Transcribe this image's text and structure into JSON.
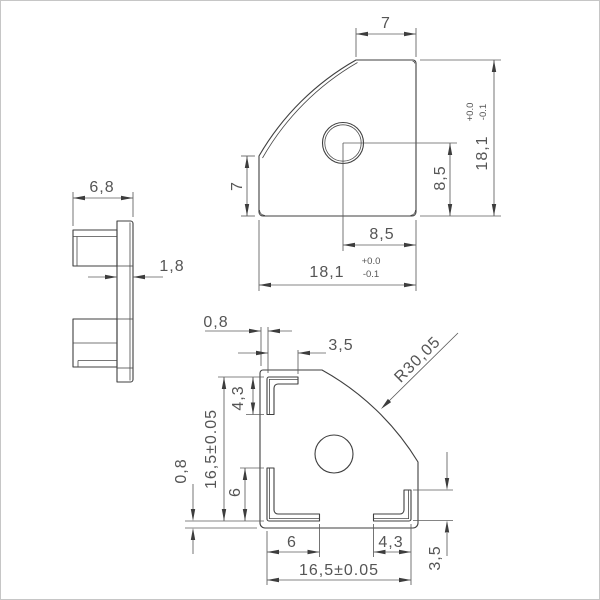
{
  "drawing_title": "end cap technical drawing",
  "tolerances": {
    "plus": "+0.0",
    "minus": "-0.1"
  },
  "front_view": {
    "top_width": "7",
    "left_height": "7",
    "hole_to_right": "8,5",
    "hole_to_bottom": "8,5",
    "overall_width": "18,1",
    "overall_height": "18,1"
  },
  "side_view": {
    "depth": "6,8",
    "plate_thickness": "1,8"
  },
  "back_view": {
    "edge_inset_top": "0,8",
    "tab_leg_top": "3,5",
    "tab_leg_left": "4,3",
    "tab_span_vertical": "16,5±0.05",
    "tab_leg_bottom_left_v": "6",
    "edge_inset_bottom": "0,8",
    "tab_leg_bottom_left_h": "6",
    "tab_leg_bottom_right": "4,3",
    "tab_span_horizontal": "16,5±0.05",
    "tab_leg_right": "3,5",
    "corner_radius": "R30,05"
  }
}
